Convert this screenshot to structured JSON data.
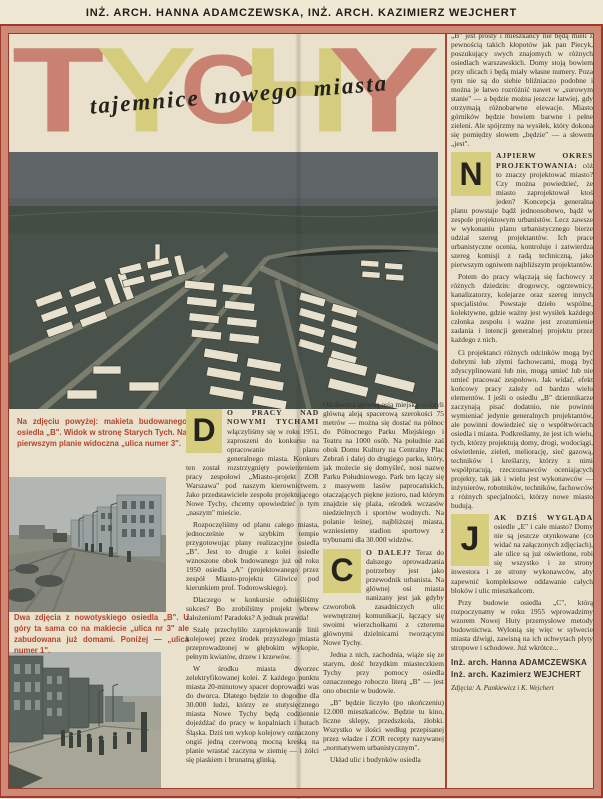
{
  "header": {
    "byline": "INŻ. ARCH. HANNA ADAMCZEWSKA, INŻ. ARCH. KAZIMIERZ WEJCHERT"
  },
  "title": {
    "letters": [
      "T",
      "Y",
      "C",
      "H",
      "Y"
    ],
    "subtitle": "tajemnice nowego miasta"
  },
  "colors": {
    "title_salmon": "#c98272",
    "title_yellow": "#d5cd7d",
    "caption_red": "#b4432e",
    "frame_red": "#9e3a28",
    "frame_salmon": "#cf8a77",
    "paper": "#e9e1cc",
    "dropcap_bg": "#d6cd7f"
  },
  "captions": {
    "model": "Na zdjęciu powyżej: makieta budowanego osiedla „B\". Widok w stronę Starych Tych. Na pierwszym planie widoczna „ulica numer 3\".",
    "streets": "Dwa zdjęcia z nowotyskiego osiedla „B\". U góry ta sama co na makiecie „ulica nr 3\" ale zabudowana już domami. Poniżej — „ulica numer 1\"."
  },
  "cols": {
    "a": {
      "dropcap": "D",
      "lead": "O PRACY NAD NOWYMI TYCHAMI",
      "p1": " włączyliśmy się w roku 1951, zaproszeni do konkursu na opracowanie planu generalnego miasta. Konkurs ten został rozstrzygnięty powierzeniem pracy zespołowi „Miasto-projekt ZOR Warszawa\" pod naszym kierownictwem. Jako przedstawiciele zespołu projektującego Nowe Tychy, chcemy opowiedzieć o tym „naszym\" mieście.",
      "p2": "Rozpoczęliśmy od planu całego miasta, jednocześnie w szybkim tempie przygotowując plany realizacyjne osiedla „B\". Jest to drugie z kolei osiedle wznoszone obok budowanego już od roku 1950 osiedla „A\" (projektowanego przez zespół Miasto-projektu Gliwice pod kierunkiem prof. Todorowskiego).",
      "p3": "Dlaczego w konkursie odnieśliśmy sukces? Bo zrobiliśmy projekt wbrew założeniom! Paradoks? A jednak prawda!",
      "p4": "Szalę przechyliło zaprojektowanie linii kolejowej przez środek przyszłego miasta przeprowadzonej w głębokim wykopie, pełnym kwiatów, drzew i krzewów.",
      "p5": "W środku miasta dworzec zelektryfikowanej kolei. Z każdego punktu miasta 20-minutowy spacer doprowadzi was do dworca. Dlatego będzie to dogodne dla 30.000 ludzi, którzy ze stutysięcznego miasta Nowe Tychy będą codziennie dojeżdżać do pracy w kopalniach i hutach Śląska. Dziś ten wykop kolejowy oznaczony ongiś jedną czerwoną mocną kreską na planie wrastać zaczyna w ziemię — i żółci się piaskiem i brunatną glinką."
    },
    "b": {
      "p1": "Od dworca główną osią miejską — czyli główną aleją spacerową szerokości 75 metrów — można się dostać na północ do Północnego Parku Miejskiego i Teatru na 1000 osób. Na południe zaś obok Domu Kultury na Centralny Plac Zebrań i dalej do drugiego parku, który, jak możecie się domyśleć, nosi nazwę Parku Południowego. Park ten łączy się z masywem lasów paprocańskich, otaczających piękne jezioro, nad którym znajdzie się plaża, ośrodek wczasów niedzielnych i sportów wodnych. Na polanie leśnej, najbliższej miasta, wzniesiemy stadion sportowy z trybunami dla 30.000 widzów.",
      "dropcap": "C",
      "lead": "O DALEJ?",
      "p2": " Teraz do dalszego oprowadzania potrzebny jest jako przewodnik urbanista. Na głównej osi miasta nanizany jest jak gdyby czworobok zasadniczych ulic wewnętrznej komunikacji, łączący się swoimi wierzchołkami z czterema głównymi dzielnicami tworzącymi Nowe Tychy.",
      "p3": "Jedna z nich, zachodnia, wiąże się ze starym, dość brzydkim miasteczkiem Tychy przy pomocy osiedla oznaczonego roboczo literą „B\" — jest ono obecnie w budowie.",
      "p4": "„B\" będzie liczyło (po ukończeniu) 12.000 mieszkańców. Będzie tu kino, liczne sklepy, przedszkola, żłobki. Wszystko w ilości według przepisanej przez władze i ZOR recepty nazywanej „normatywem urbanistycznym\".",
      "p5": "Układ ulic i budynków osiedla"
    }
  },
  "right": {
    "p1": "„B\" jest prosty i mieszkańcy nie będą mieli z pewnością takich kłopotów jak pan Piecyk, poszukujący swych znajomych w różnych osiedlach warszawskich. Domy stoją bowiem przy ulicach i będą miały własne numery. Poza tym nie są do siebie bliźniaczo podobne i można je łatwo rozróżnić nawet w „surowym stanie\" — a będzie można jeszcze łatwiej, gdy otrzymają różnobarwne elewacje. Miasto górników będzie bowiem barwne i pełne zieleni. Ale spójrzmy na wysiłek, który dokona się pomiędzy słowem „będzie\" — a słowem „jest\".",
    "n_dropcap": "N",
    "n_lead": "AJPIERW OKRES PROJEKTOWANIA:",
    "n_rest": " cóż to znaczy projektować miasto? Czy można powiedzieć, że miasto zaprojektował ktoś jeden? Koncepcja generalna planu powstaje bądź jednoosobowo, bądź w zespole projektowym urbanistów. Lecz zawsze w wykonaniu planu urbanistycznego bierze udział szereg projektantów. Ich prace urbanistyczne ocenia, kontroluje i zatwierdza szereg komisji z radą techniczną, jako pierwszym ogniwem najbliższym projektantów.",
    "p3": "Potem do pracy włączają się fachowcy z różnych dziedzin: drogowcy, ogrzewnicy, kanalizatorzy, kolejarze oraz szereg innych specjalistów. Powstaje dzieło wspólne, kolektywne, gdzie ważny jest wysiłek każdego członka zespołu i ważne jest zrozumienie zadania i intencji generalnej projektu przez każdego z nich.",
    "p4": "Ci projektanci różnych odcinków mogą być dobrymi lub złymi fachowcami, mogą być zdyscyplinowani lub nie, mogą umieć lub nie umieć pracować zespołowo. Jak widać, efekt końcowy pracy zależy od bardzo wielu elementów. I jeśli o osiedlu „B\" dziennikarze zaczynają pisać dodatnio, nie powinni wymieniać jedynie generalnych projektantów, ale powinni dowiedzieć się o współtwórcach osiedla i miasta. Podkreślamy, że jest ich wielu, tych, którzy projektują domy, drogi, wodociągi, oświetlenie, zieleń, meliorację, sieć gazową, techników i kreślarzy, którzy z nimi współpracują, rzeczoznawców oceniających projekty, tak jak i wielu jest wykonawców — inżynierów, robotników, techników, fachowców z różnych specjalności, którzy nowe miasto budują.",
    "j_dropcap": "J",
    "j_lead": "AK DZIŚ WYGLĄDA",
    "j_rest": " osiedle „E\" i całe miasto? Domy nie są jeszcze otynkowane (co widać na załączonych zdjęciach), ale ulice są już oświetlone, robi się wszystko i ze strony inwestora i ze strony wykonawców, aby zapewnić kompleksowe oddawanie całych bloków i ulic mieszkańcom.",
    "p6": "Przy budowie osiedla „C\", którą rozpoczynamy w roku 1955 wprowadzimy wzorem Nowej Huty przemysłowe metody budownictwa. Wylonią się więc w sylwecie miasta dźwigi, zawisną na ich uchwytach płyty stropowe i schodowe. Już wkrótce...",
    "sig1": "Inż. arch. Hanna ADAMCZEWSKA",
    "sig2": "Inż. arch. Kazimierz WEJCHERT",
    "credit": "Zdjęcia: A. Pankiewicz i K. Wejchert"
  }
}
